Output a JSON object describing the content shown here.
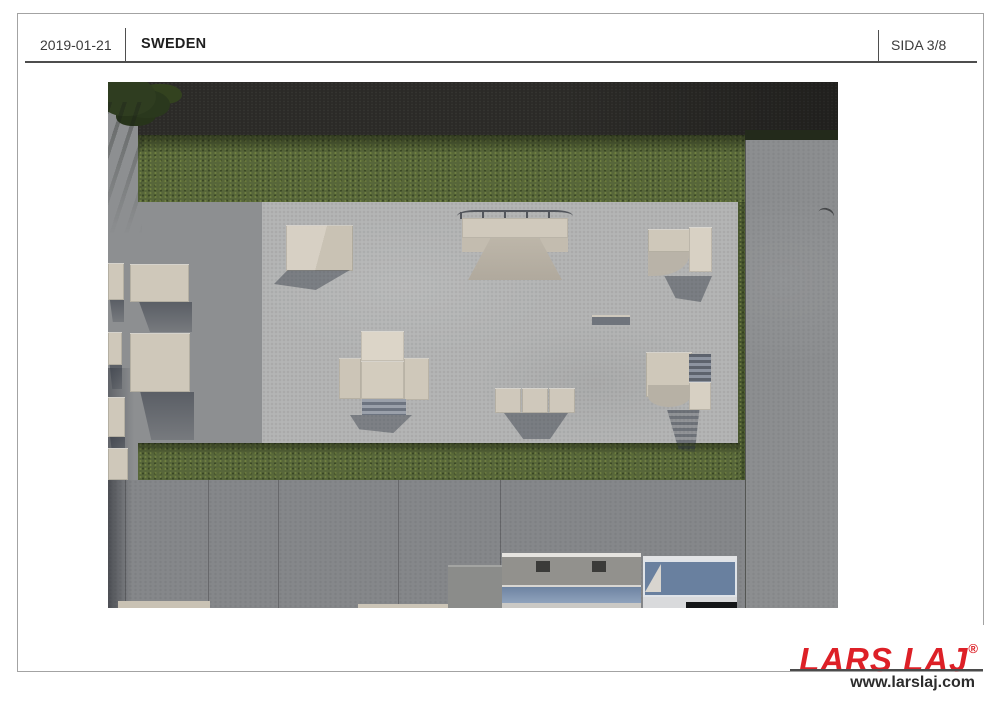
{
  "header": {
    "date": "2019-01-21",
    "title": "SWEDEN",
    "page_label": "SIDA 3/8"
  },
  "footer": {
    "brand": "LARS LAJ",
    "registered_mark": "®",
    "website": "www.larslaj.com"
  },
  "colors": {
    "brand_red": "#dd2027",
    "frame_gray": "#a3a3a3",
    "header_line": "#4d4d4d",
    "asphalt_road": "#2b2a27",
    "grass_green": "#57663a",
    "skate_pad_concrete": "#b4b5b5",
    "walkway_concrete": "#8d8f91",
    "slab_concrete": "#8c8e90",
    "pavement_concrete": "#85878a",
    "equipment_beige": "#cfc8ba",
    "roof_blue": "#69809f",
    "shadow_blue_gray": "#2b3240"
  },
  "scene": {
    "kind": "aerial-top-down-3d-render",
    "subject": "skatepark concrete pad with ramps and ledges, bordered by grass strips, asphalt road, walkways and building rooftops"
  }
}
